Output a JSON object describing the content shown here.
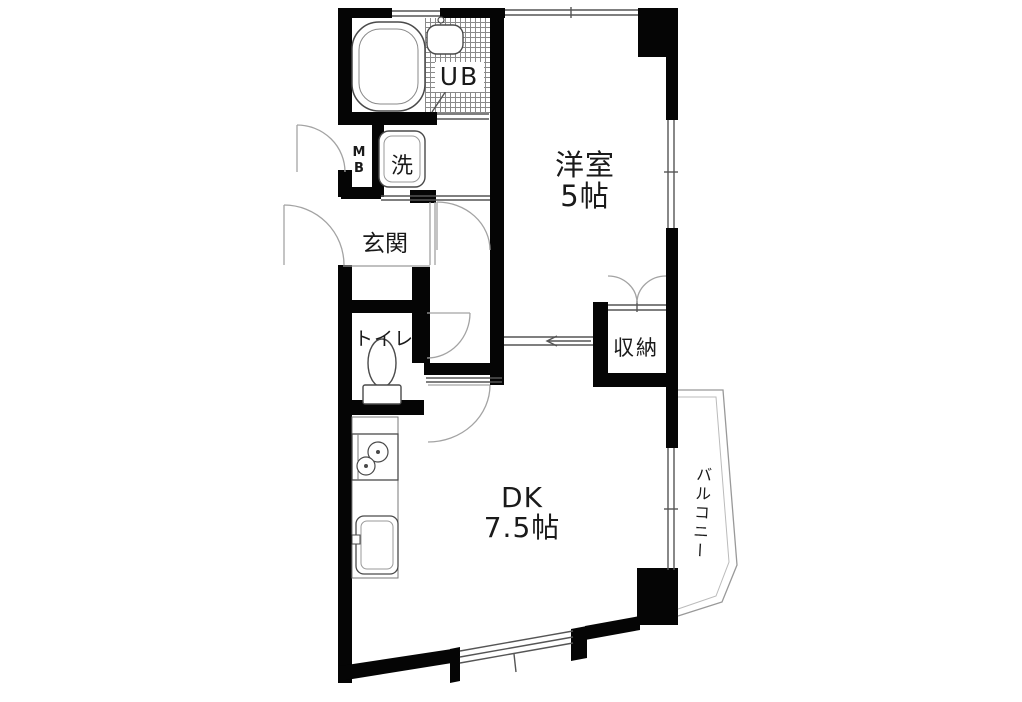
{
  "floor_plan": {
    "western_room": {
      "name": "洋室",
      "size": "5帖"
    },
    "dining_kitchen": {
      "name": "DK",
      "size": "7.5帖"
    },
    "entrance_label": "玄関",
    "toilet_label": "トイレ",
    "washer_label": "洗",
    "meter_box_letters": [
      "M",
      "B"
    ],
    "unit_bath_label": "UB",
    "storage_label": "収納",
    "balcony_label": "バルコニー",
    "colors": {
      "wall": "#050505",
      "background": "#ffffff",
      "fixture_line": "#4a4a4a",
      "window_line": "#555555",
      "door_arc": "#a3a3a3",
      "text": "#1a1a1a"
    }
  }
}
